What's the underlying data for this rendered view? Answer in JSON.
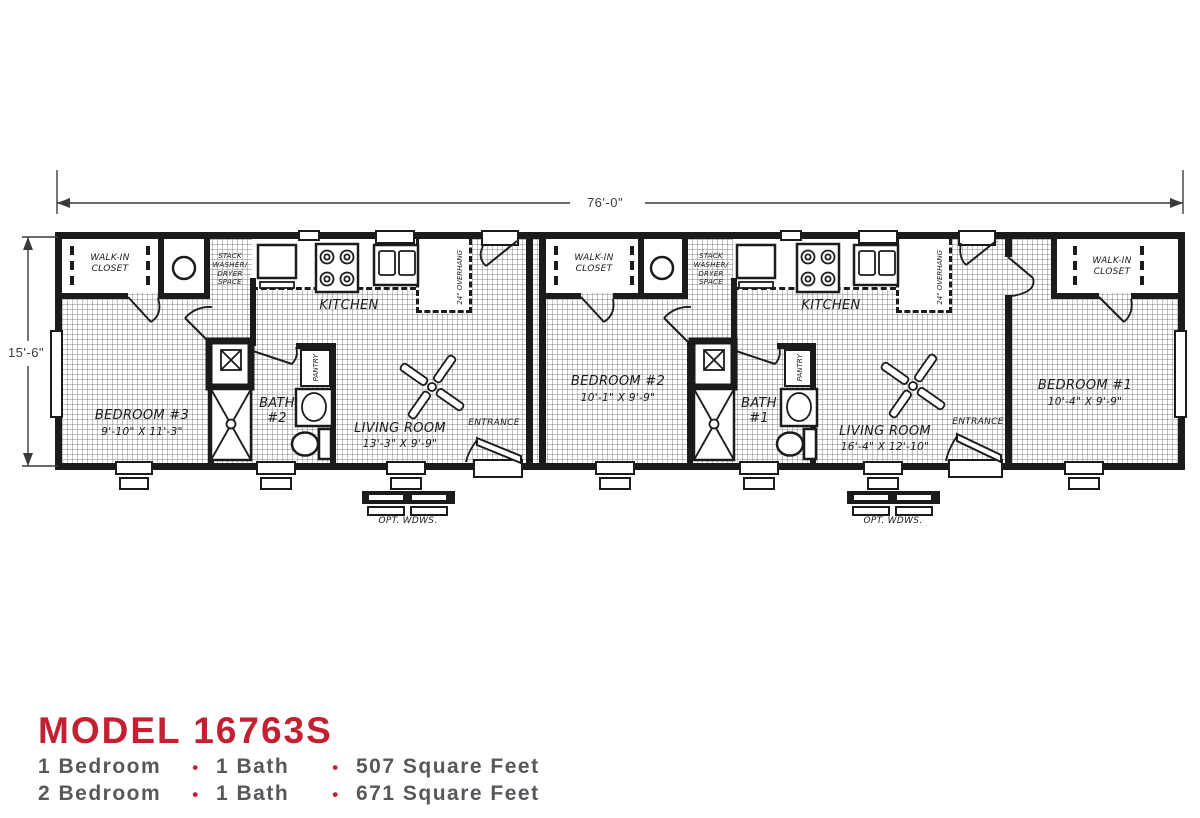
{
  "colors": {
    "accent": "#c32032",
    "text_gray": "#57585b",
    "wall": "#1b1b1b"
  },
  "dims": {
    "width_label": "76'-0\"",
    "height_label": "15'-6\""
  },
  "left": {
    "closet": "WALK-IN\nCLOSET",
    "washer": "STACK\nWASHER/\nDRYER\nSPACE",
    "kitchen": "KITCHEN",
    "overhang": "24\" OVERHANG",
    "bedroom_name": "BEDROOM #3",
    "bedroom_size": "9'-10\" X 11'-3\"",
    "bath": "BATH\n#2",
    "pantry": "PANTRY",
    "living_name": "LIVING ROOM",
    "living_size": "13'-3\" X 9'-9\"",
    "entrance": "ENTRANCE",
    "opt": "OPT. WDWS."
  },
  "right": {
    "closet2": "WALK-IN\nCLOSET",
    "washer": "STACK\nWASHER/\nDRYER\nSPACE",
    "kitchen": "KITCHEN",
    "overhang": "24\" OVERHANG",
    "bedroom2_name": "BEDROOM #2",
    "bedroom2_size": "10'-1\" X 9'-9\"",
    "bath": "BATH\n#1",
    "pantry": "PANTRY",
    "living_name": "LIVING ROOM",
    "living_size": "16'-4\" X 12'-10\"",
    "entrance": "ENTRANCE",
    "bedroom1_name": "BEDROOM #1",
    "bedroom1_size": "10'-4\" X 9'-9\"",
    "closet1": "WALK-IN\nCLOSET",
    "opt": "OPT. WDWS."
  },
  "footer": {
    "model": "MODEL 16763S",
    "specs": [
      {
        "beds": "1 Bedroom",
        "bullet": "•",
        "bath": "1 Bath",
        "sqft": "507 Square Feet"
      },
      {
        "beds": "2 Bedroom",
        "bullet": "•",
        "bath": "1 Bath",
        "sqft": "671 Square Feet"
      }
    ]
  }
}
